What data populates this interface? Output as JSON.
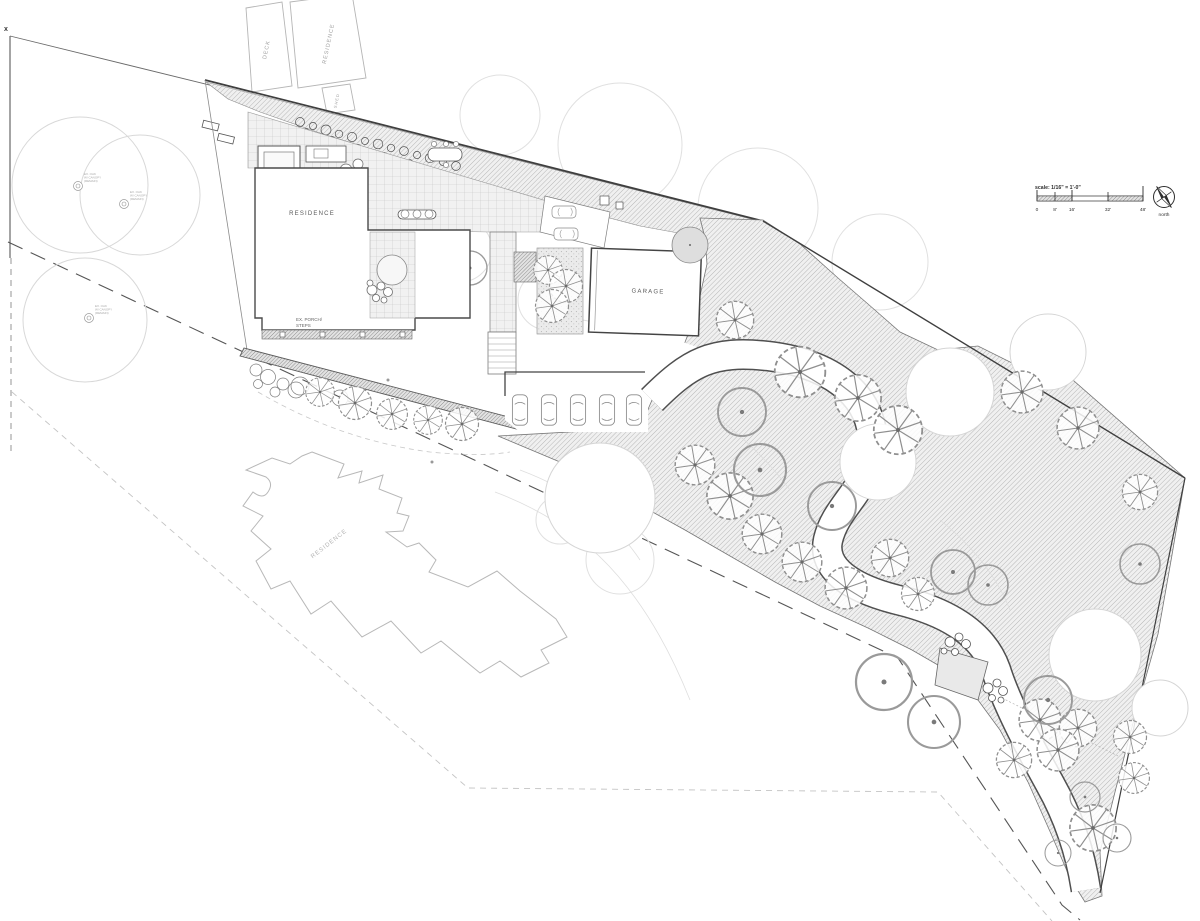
{
  "plan": {
    "labels": {
      "corner_marker": "x",
      "neighbor_deck": "DECK",
      "neighbor_residence_top": "RESIDENCE",
      "neighbor_shed": "SHED",
      "main_residence": "RESIDENCE",
      "ex_porch_line1": "EX. PORCH/",
      "ex_porch_line2": "STEPS",
      "garage": "GARAGE",
      "neighbor_residence_bottom": "RESIDENCE"
    },
    "tree_note": {
      "line1": "EX. OAK",
      "line2": "W/ CANOPY",
      "line3": "(REMAIN)"
    },
    "scale_bar": {
      "label": "scale: 1/16\" = 1'-0\"",
      "ticks": [
        "0",
        "8'",
        "16'",
        "32'",
        "48'"
      ]
    },
    "north_arrow": {
      "label": "north"
    },
    "colors": {
      "paper": "#ffffff",
      "boundary": "#3f3f3f",
      "building_outline": "#4a4a4a",
      "hatch_line": "#9f9f9f",
      "canopy_outline": "#d8d8d8",
      "driveway_edge": "#4f4f4f"
    }
  }
}
